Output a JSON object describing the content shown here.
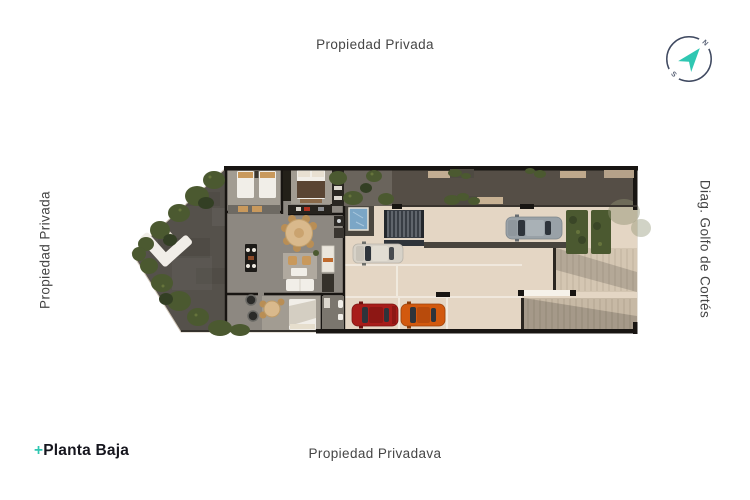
{
  "canvas": {
    "width": 750,
    "height": 500,
    "background": "#ffffff"
  },
  "labels": {
    "top": "Propiedad Privada",
    "bottom": "Propiedad Privadava",
    "left": "Propiedad Privada",
    "right": "Diag. Golfo de Cortés",
    "color": "#454545"
  },
  "logo": {
    "plus": "+",
    "name": "Planta Baja",
    "plus_color": "#2fc7b2",
    "text_color": "#16161e"
  },
  "compass": {
    "north": "N",
    "south": "S",
    "arrow_color": "#2fc7b2",
    "ring_color": "#3f4960",
    "letter_color": "#5a6377"
  },
  "palette": {
    "wall": "#181512",
    "patio": "#55514b",
    "indoor": "#8d8881",
    "room": "#a29c92",
    "terrace": "#6a645c",
    "walkway": "#554e46",
    "parking": "#e4d6c4",
    "ramp_hi": "#d4c6b2",
    "ramp_lo": "#c7b9a5",
    "pool": "#7ba6c6",
    "stairs": "#383d44",
    "green": "#4b5930",
    "green_dark": "#333f24",
    "green_light": "#66743c",
    "furn_white": "#f1eee8",
    "furn_tan": "#c9995c",
    "furn_table": "#d9b98c",
    "furn_chair": "#b98e55",
    "blanket": "#5a4533",
    "line": "#f3eee5"
  },
  "cars": {
    "white": "#d7d2c8",
    "gray": "#99a1a7",
    "red": "#a81d1a",
    "orange": "#d2590e",
    "glass": "#2e343b"
  }
}
